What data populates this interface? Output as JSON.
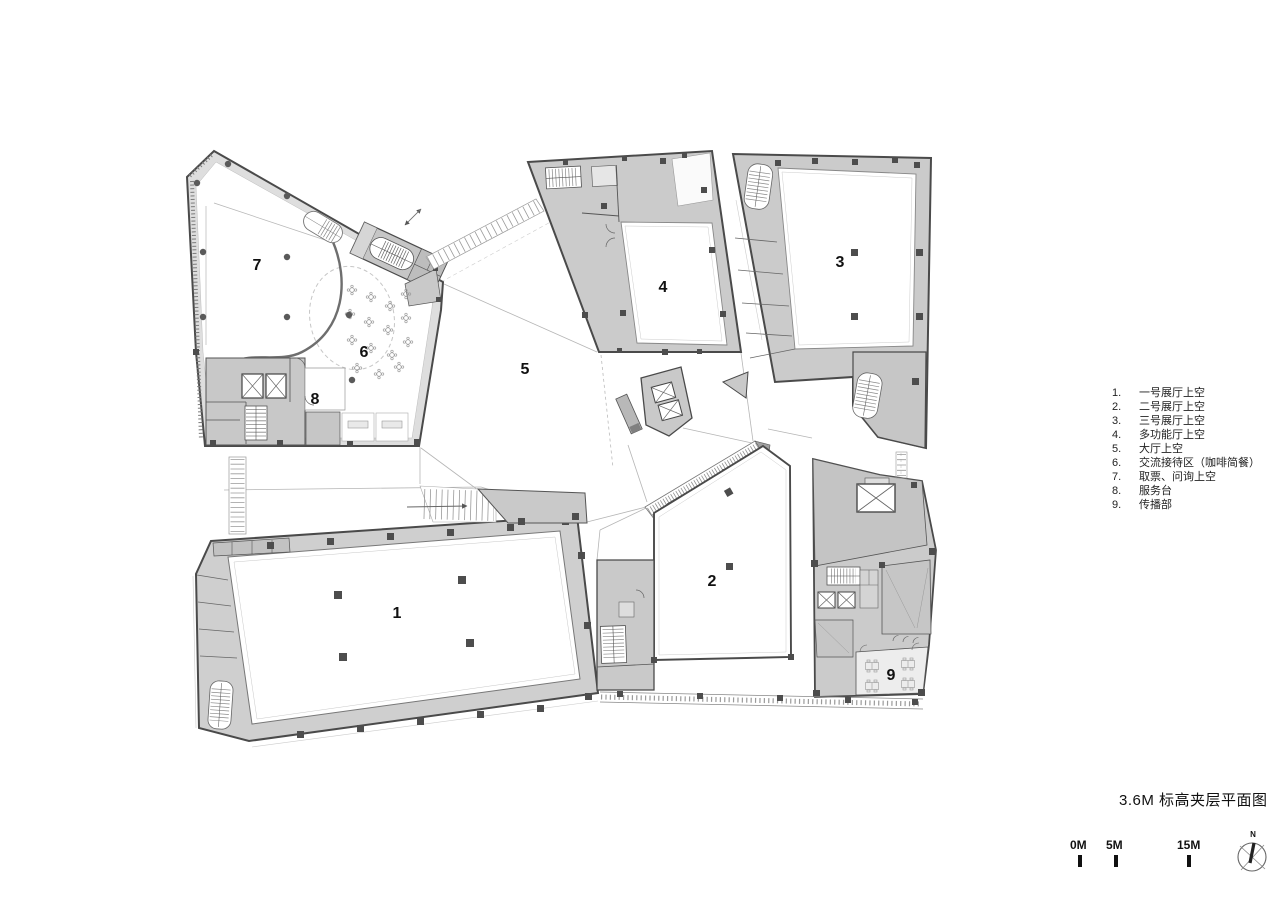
{
  "title": "3.6M 标高夹层平面图",
  "legend": {
    "items": [
      {
        "num": "1.",
        "label": "一号展厅上空"
      },
      {
        "num": "2.",
        "label": "二号展厅上空"
      },
      {
        "num": "3.",
        "label": "三号展厅上空"
      },
      {
        "num": "4.",
        "label": "多功能厅上空"
      },
      {
        "num": "5.",
        "label": "大厅上空"
      },
      {
        "num": "6.",
        "label": "交流接待区（咖啡简餐）"
      },
      {
        "num": "7.",
        "label": "取票、问询上空"
      },
      {
        "num": "8.",
        "label": "服务台"
      },
      {
        "num": "9.",
        "label": "传播部"
      }
    ]
  },
  "rooms": {
    "r1": "1",
    "r2": "2",
    "r3": "3",
    "r4": "4",
    "r5": "5",
    "r6": "6",
    "r7": "7",
    "r8": "8",
    "r9": "9"
  },
  "scalebar": {
    "t0": "0M",
    "t5": "5M",
    "t15": "15M"
  },
  "north_label": "N",
  "colors": {
    "wall": "#4a4a4a",
    "poche": "#cbcbcb",
    "poche_light": "#dedede",
    "void": "#ffffff",
    "thin_line": "#b5b5b5"
  }
}
